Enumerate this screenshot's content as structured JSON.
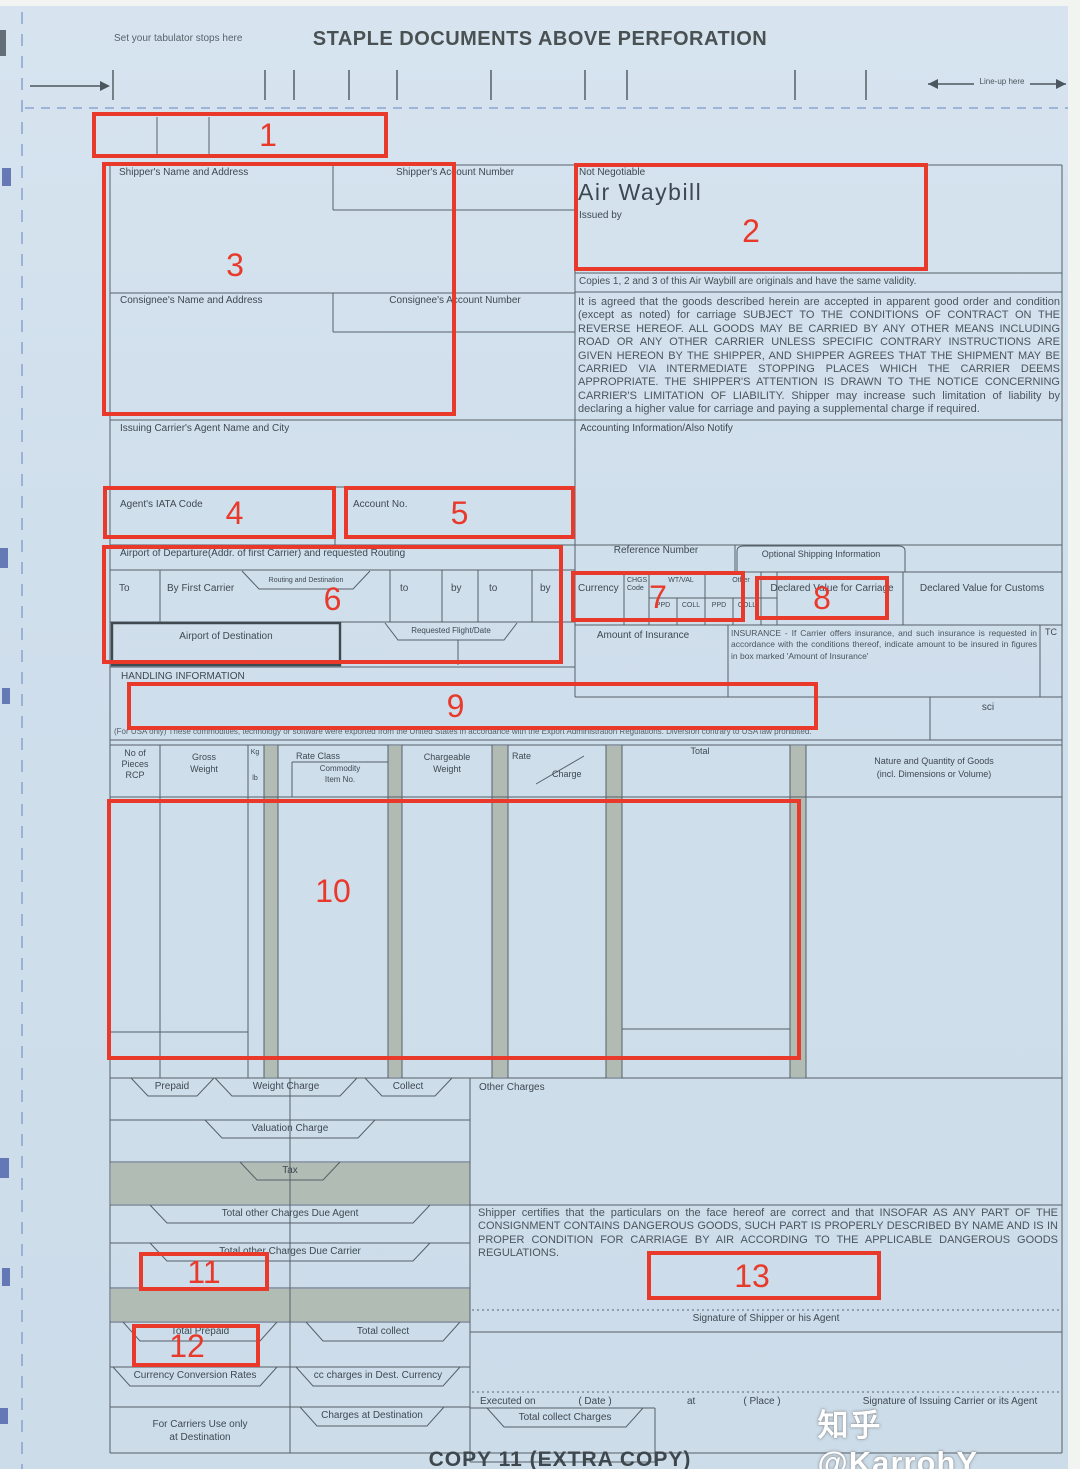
{
  "page": {
    "tabulator_note": "Set your tabulator stops here",
    "staple_title": "STAPLE DOCUMENTS ABOVE PERFORATION",
    "lineup_note": "Line-up here",
    "copy_footer": "COPY 11 (EXTRA COPY)",
    "watermark": "知乎 @KarrohY",
    "red_color": "#e8392b",
    "paper_color": "#d0dfec",
    "line_color": "#566068",
    "grey_band_color": "#a6ae9f"
  },
  "annotations": {
    "numbers": [
      "1",
      "2",
      "3",
      "4",
      "5",
      "6",
      "7",
      "8",
      "9",
      "10",
      "11",
      "12",
      "13"
    ]
  },
  "awb": {
    "shipper_name": "Shipper's Name and Address",
    "shipper_account": "Shipper's Account Number",
    "consignee_name": "Consignee's Name and Address",
    "consignee_account": "Consignee's Account Number",
    "not_negotiable": "Not Negotiable",
    "title": "Air Waybill",
    "issued_by": "Issued by",
    "copies_note": "Copies 1, 2 and 3 of this  Air Waybill are originals and have the same validity.",
    "conditions": "It is agreed that the goods described herein are accepted in apparent good order and condition (except as noted) for carriage SUBJECT TO THE CONDITIONS OF CONTRACT ON THE REVERSE HEREOF. ALL GOODS MAY BE CARRIED BY ANY OTHER MEANS INCLUDING ROAD OR ANY OTHER CARRIER UNLESS SPECIFIC CONTRARY INSTRUCTIONS ARE GIVEN HEREON BY THE SHIPPER, AND SHIPPER AGREES THAT THE SHIPMENT MAY BE CARRIED VIA INTERMEDIATE STOPPING PLACES WHICH THE CARRIER DEEMS APPROPRIATE. THE SHIPPER'S ATTENTION IS DRAWN TO THE NOTICE CONCERNING CARRIER'S LIMITATION OF LIABILITY. Shipper may increase such limitation of liability by declaring a higher value for carriage and paying a supplemental charge if required.",
    "issuing_agent": "Issuing Carrier's Agent Name and City",
    "accounting": "Accounting Information/Also Notify",
    "iata_code": "Agent's IATA Code",
    "account_no": "Account No.",
    "departure": "Airport of Departure(Addr. of first Carrier) and requested Routing",
    "to_cap": "To",
    "by_first_carrier": "By First Carrier",
    "routing_destination": "Routing and Destination",
    "to_lc": "to",
    "by_lc": "by",
    "reference_number": "Reference Number",
    "optional_shipping": "Optional Shipping Information",
    "currency": "Currency",
    "chgs": "CHGS",
    "code": "Code",
    "wt_val": "WT/VAL",
    "other": "Other",
    "ppd": "PPD",
    "coll": "COLL",
    "declared_carriage": "Declared Value for Carriage",
    "declared_customs": "Declared Value for Customs",
    "destination": "Airport of Destination",
    "requested_flight": "Requested Flight/Date",
    "amount_insurance": "Amount of Insurance",
    "insurance_note": "INSURANCE  -  If Carrier offers insurance, and such insurance is requested in  accordance  with the conditions  thereof, indicate amount to be insured in figures in box marked 'Amount of Insurance'",
    "tc": "TC",
    "handling": "HANDLING INFORMATION",
    "sci": "sci",
    "usa_note": "(For USA only) These commodities, technology or software were exported from the United States in accordance with the Export Administration Regulations. Diversion contrary to USA law prohibited.",
    "table": {
      "no_of": "No of",
      "pieces": "Pieces",
      "rcp": "RCP",
      "gross": "Gross",
      "weight": "Weight",
      "kg": "Kg",
      "lb": "lb",
      "rate_class": "Rate Class",
      "commodity": "Commodity",
      "item_no": "Item No.",
      "chargeable": "Chargeable",
      "rate": "Rate",
      "charge": "Charge",
      "total": "Total",
      "nature1": "Nature and Quantity of Goods",
      "nature2": "(incl. Dimensions or Volume)"
    },
    "charges": {
      "prepaid": "Prepaid",
      "weight_charge": "Weight Charge",
      "collect": "Collect",
      "other_charges": "Other Charges",
      "valuation": "Valuation Charge",
      "tax": "Tax",
      "due_agent": "Total other Charges Due Agent",
      "due_carrier": "Total other Charges Due Carrier",
      "total_prepaid": "Total Prepaid",
      "total_collect": "Total collect",
      "currency_conversion": "Currency Conversion Rates",
      "cc_charges": "cc charges in Dest. Currency",
      "carriers_use1": "For Carriers Use only",
      "carriers_use2": "at Destination",
      "charges_destination": "Charges at Destination",
      "total_collect_charges": "Total collect Charges"
    },
    "certification": "Shipper certifies that the particulars on the face hereof are correct and that INSOFAR AS ANY PART OF THE CONSIGNMENT CONTAINS DANGEROUS GOODS, SUCH PART IS PROPERLY DESCRIBED BY NAME AND IS IN PROPER CONDITION FOR CARRIAGE BY AIR ACCORDING TO THE APPLICABLE DANGEROUS GOODS REGULATIONS.",
    "sig_shipper": "Signature of Shipper or his Agent",
    "executed_on": "Executed on",
    "date": "( Date )",
    "at": "at",
    "place": "( Place )",
    "sig_carrier": "Signature of Issuing  Carrier or its Agent"
  }
}
